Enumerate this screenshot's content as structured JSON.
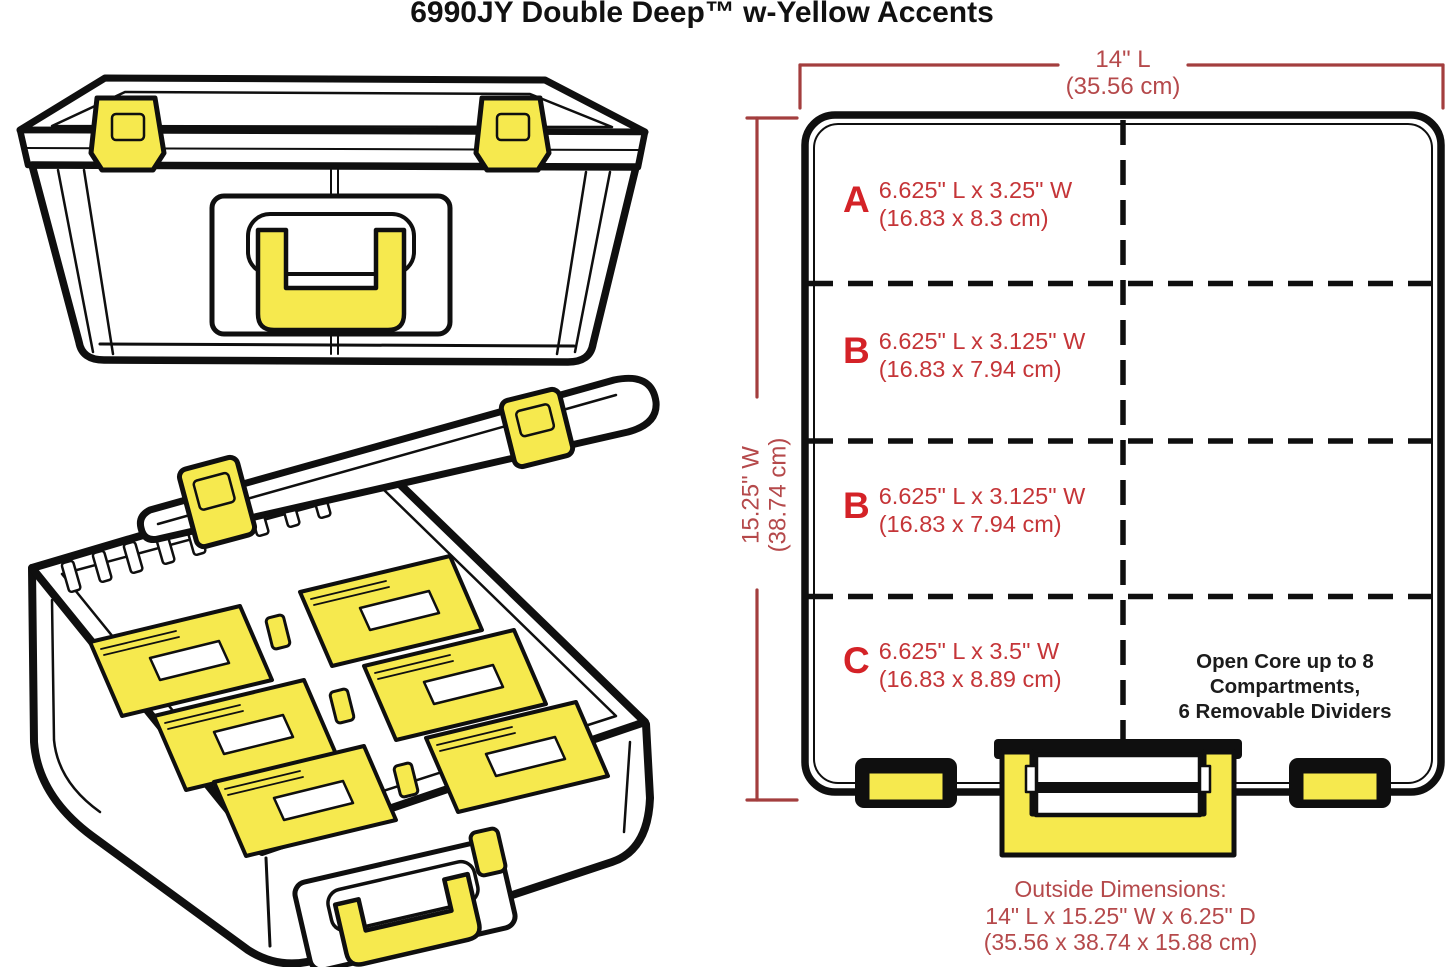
{
  "title": "6990JY Double Deep™ w-Yellow Accents",
  "colors": {
    "accent_yellow": "#f6e94e",
    "outline_black": "#0f0f0f",
    "dimension_line_red": "#a33e3e",
    "dimension_text_red": "#b5494b",
    "compartment_text_red": "#c53538",
    "compartment_letter_red": "#d42227",
    "note_text_black": "#1c1c1c"
  },
  "dimensions": {
    "length": {
      "value": "14\" L",
      "metric": "(35.56 cm)"
    },
    "width": {
      "value": "15.25\" W",
      "metric": "(38.74 cm)"
    },
    "outside": {
      "heading": "Outside Dimensions:",
      "imperial": "14\" L x 15.25\" W x 6.25\" D",
      "metric": "(35.56 x 38.74 x 15.88 cm)"
    }
  },
  "compartments": [
    {
      "letter": "A",
      "imperial": "6.625\" L x 3.25\" W",
      "metric": "(16.83 x 8.3 cm)"
    },
    {
      "letter": "B",
      "imperial": "6.625\" L x 3.125\" W",
      "metric": "(16.83 x 7.94 cm)"
    },
    {
      "letter": "B",
      "imperial": "6.625\" L x 3.125\" W",
      "metric": "(16.83 x 7.94 cm)"
    },
    {
      "letter": "C",
      "imperial": "6.625\" L x 3.5\" W",
      "metric": "(16.83 x 8.89 cm)"
    }
  ],
  "notes": {
    "open_core_line1": "Open Core up to 8 Compartments,",
    "open_core_line2": "6 Removable Dividers"
  }
}
